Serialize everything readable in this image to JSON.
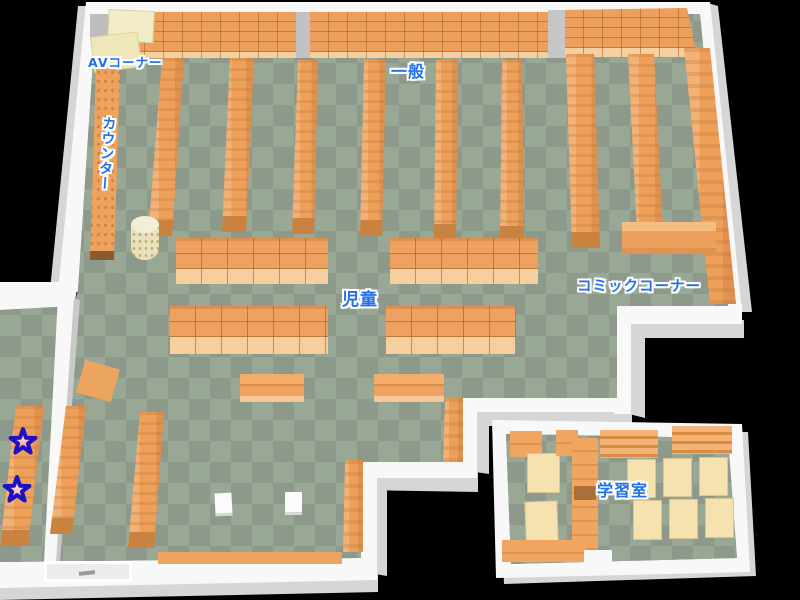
{
  "map": {
    "type": "library-floor-map",
    "labels": [
      {
        "id": "av-corner",
        "text": "AVコーナー"
      },
      {
        "id": "counter",
        "text": "カウンター"
      },
      {
        "id": "general",
        "text": "一般"
      },
      {
        "id": "children",
        "text": "児童"
      },
      {
        "id": "comic-corner",
        "text": "コミックコーナー"
      },
      {
        "id": "study-room",
        "text": "学習室"
      }
    ],
    "markers": [
      {
        "id": "star-1",
        "shape": "star",
        "fill": "#ef5f78",
        "outline": "#1c12c4"
      },
      {
        "id": "star-2",
        "shape": "star",
        "fill": "#f47e92",
        "outline": "#1c12c4"
      }
    ],
    "colors": {
      "background": "#000000",
      "floor_dark": "#8d998b",
      "floor_light": "#99a795",
      "shelf": "#efa25f",
      "shelf_edge": "#c9823f",
      "shelf_lip": "#f6cf9e",
      "wall": "#f8f8f8",
      "wall_shade": "#d6d6d6",
      "desk": "#f6e2ae",
      "av_desk": "#f2ecca",
      "label_text": "#2071e8"
    }
  }
}
